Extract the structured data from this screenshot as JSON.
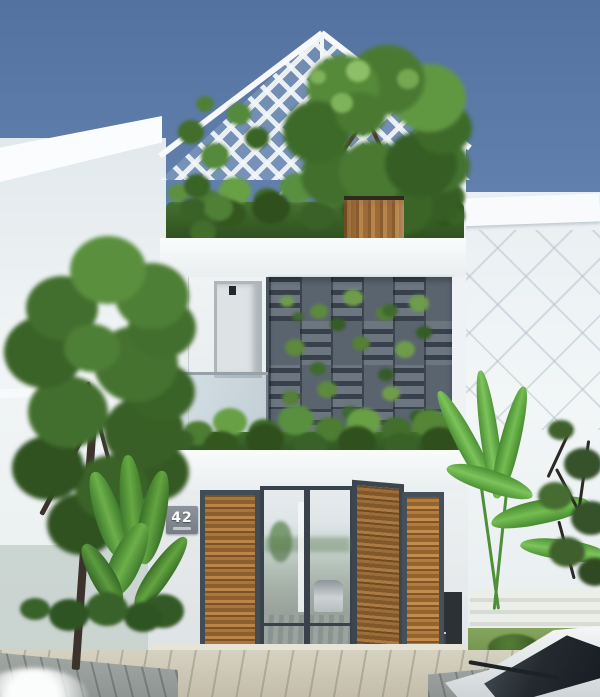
{
  "scene": {
    "house_number": "42"
  },
  "colors": {
    "sky_top": "#54729f",
    "sky_bottom": "#8ca3c4",
    "facade": "#f2f4f5",
    "screen_base": "#5a646f",
    "screen_slat_dark": "#38414b",
    "frame": "#424c55",
    "wood_light": "#b5854c",
    "wood_dark": "#8a5c2e",
    "foliage_dark": "#2f4f1d",
    "foliage_mid": "#4d7c33",
    "foliage_light": "#6f9c4b",
    "paving": "#c3bda9",
    "deck": "#9aa19e",
    "car_body": "#eef1f2",
    "car_glass": "#242a30"
  }
}
